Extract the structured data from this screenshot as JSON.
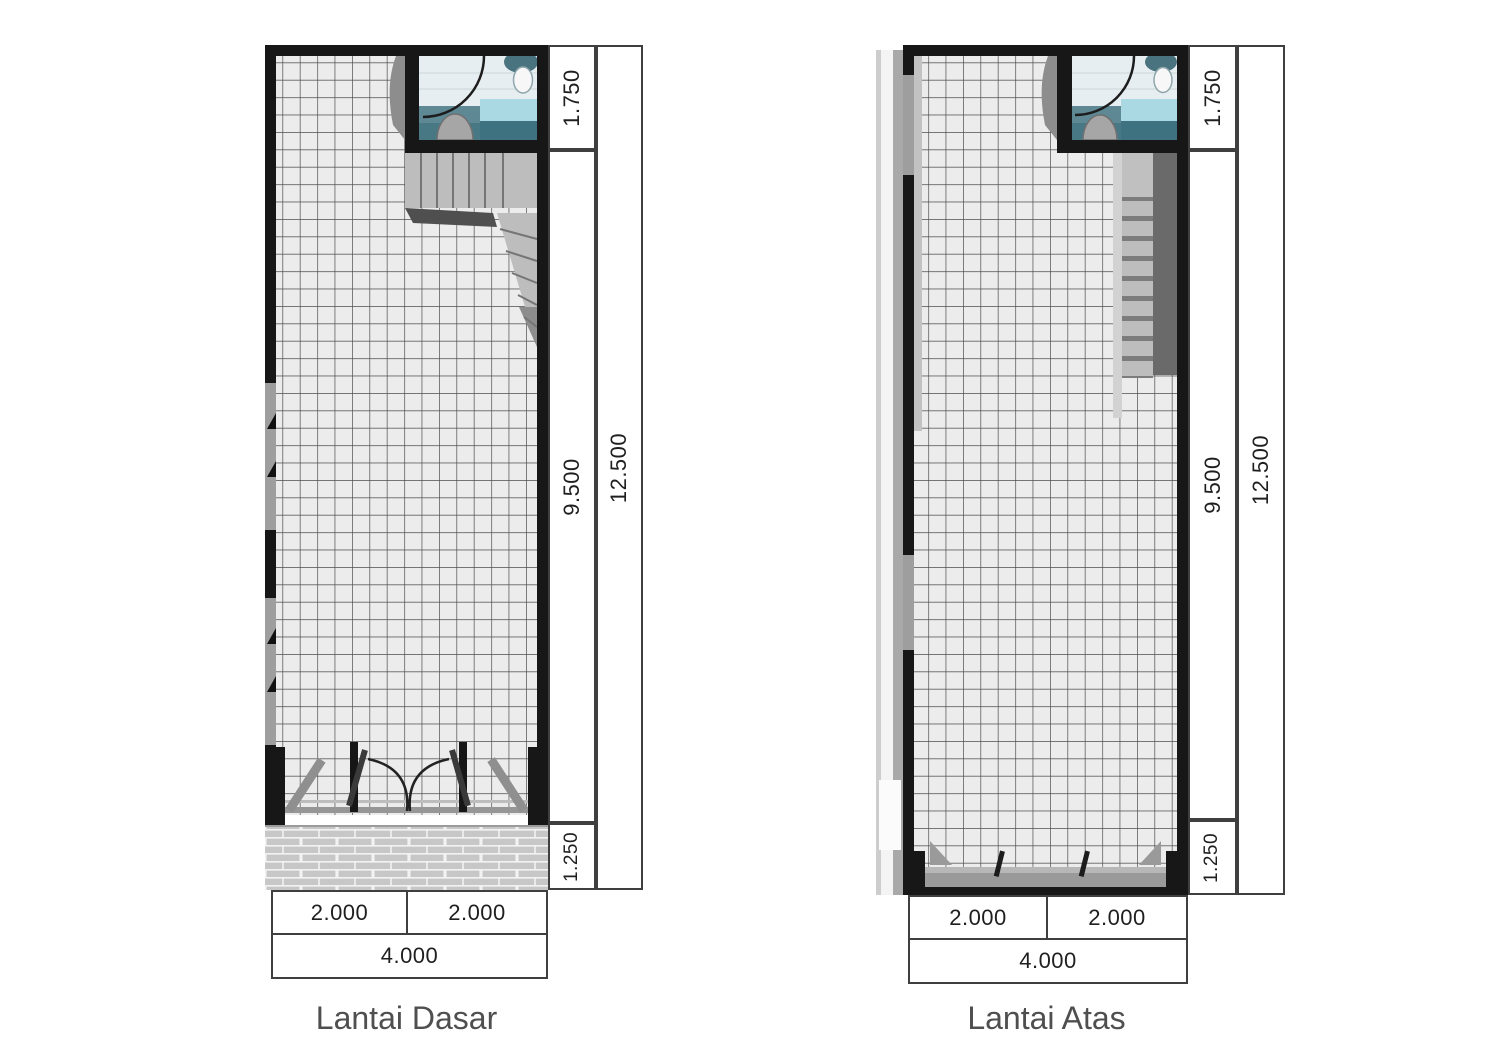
{
  "plans": [
    {
      "title": "Lantai Dasar",
      "dims": {
        "v_top": "1.750",
        "v_mid": "9.500",
        "v_bottom": "1.250",
        "v_total": "12.500",
        "h_left": "2.000",
        "h_right": "2.000",
        "h_total": "4.000"
      }
    },
    {
      "title": "Lantai Atas",
      "dims": {
        "v_top": "1.750",
        "v_mid": "9.500",
        "v_bottom": "1.250",
        "v_total": "12.500",
        "h_left": "2.000",
        "h_right": "2.000",
        "h_total": "4.000"
      }
    }
  ],
  "colors": {
    "wall": "#171717",
    "tile_floor": "#ececec",
    "tile_line": "#4d4d4d",
    "stair_gray": "#bdbdbd",
    "stair_void": "#6a6a6a",
    "bath_floor": "#e7eef1",
    "bath_tile": "#5d8894",
    "bath_tile_dark": "#497885",
    "water_tub": "#aad8e3",
    "brick": "#c7c7c7",
    "dim_line": "#3f3f3f",
    "dim_text": "#1f1f1f",
    "title_text": "#4f4f4f"
  }
}
